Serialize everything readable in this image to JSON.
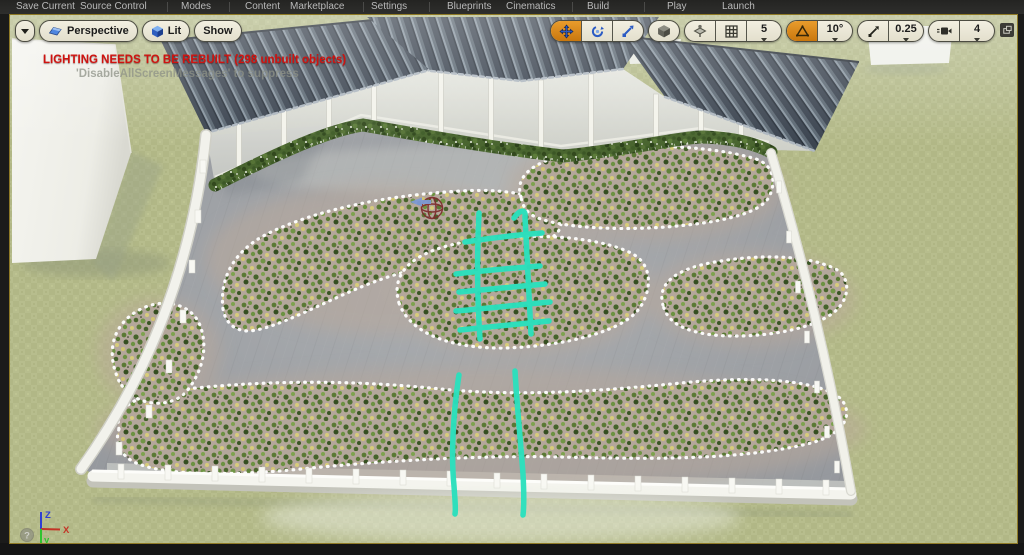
{
  "menubar": {
    "items": [
      {
        "label": "Save Current"
      },
      {
        "label": "Source Control"
      },
      {
        "label": "Modes"
      },
      {
        "label": "Content"
      },
      {
        "label": "Marketplace"
      },
      {
        "label": "Settings"
      },
      {
        "label": "Blueprints"
      },
      {
        "label": "Cinematics"
      },
      {
        "label": "Build"
      },
      {
        "label": "Play"
      },
      {
        "label": "Launch"
      }
    ]
  },
  "viewport": {
    "toolbar": {
      "perspective_label": "Perspective",
      "lit_label": "Lit",
      "show_label": "Show",
      "grid_snap_value": "5",
      "rotation_snap_value": "10°",
      "scale_snap_value": "0.25",
      "camera_speed_value": "4"
    },
    "warning": {
      "line1": "LIGHTING NEEDS TO BE REBUILT (298 unbuilt objects)",
      "line2": "'DisableAllScreenMessages' to suppress"
    },
    "axis_gizmo": {
      "x_label": "X",
      "y_label": "y",
      "z_label": "Z",
      "help_glyph": "?"
    }
  },
  "colors": {
    "active_tool_orange": "#d07f1f",
    "selection_teal": "#2be0bd",
    "warning_red": "#cf1310",
    "viewport_border": "#8f7a26"
  }
}
